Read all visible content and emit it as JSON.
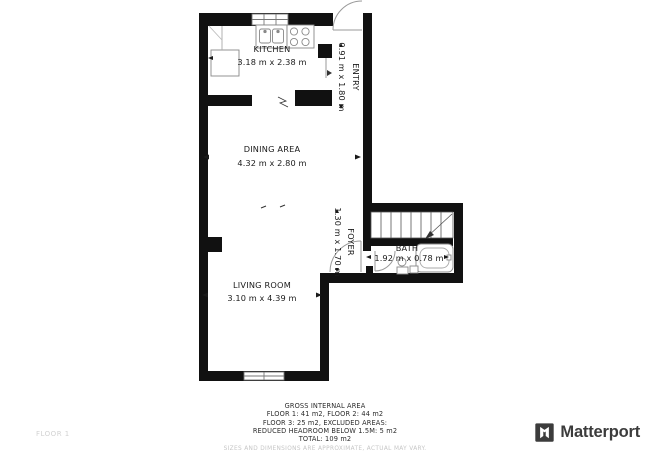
{
  "floorplan": {
    "rooms": [
      {
        "id": "kitchen",
        "name": "KITCHEN",
        "dims": "3.18 m x 2.38 m"
      },
      {
        "id": "entry",
        "name": "ENTRY",
        "dims": "0.91 m x 1.80 m"
      },
      {
        "id": "dining",
        "name": "DINING AREA",
        "dims": "4.32 m x 2.80 m"
      },
      {
        "id": "foyer",
        "name": "FOYER",
        "dims": "1.30 m x 1.70 m"
      },
      {
        "id": "bath",
        "name": "BATH",
        "dims": "1.92 m x 0.78 m"
      },
      {
        "id": "living",
        "name": "LIVING ROOM",
        "dims": "3.10 m x 4.39 m"
      }
    ],
    "colors": {
      "wall": "#111111",
      "fixture": "#888888",
      "door_arc": "#999999",
      "label": "#1a1a1a"
    }
  },
  "footer": {
    "lines": [
      "GROSS INTERNAL AREA",
      "FLOOR 1: 41 m2, FLOOR 2: 44 m2",
      "FLOOR 3: 25 m2, EXCLUDED AREAS:",
      "REDUCED HEADROOM BELOW 1.5M: 5 m2",
      "TOTAL: 109 m2"
    ],
    "disclaimer": "SIZES AND DIMENSIONS ARE APPROXIMATE, ACTUAL MAY VARY.",
    "floor_label": "FLOOR 1"
  },
  "branding": {
    "logo_text": "Matterport"
  }
}
